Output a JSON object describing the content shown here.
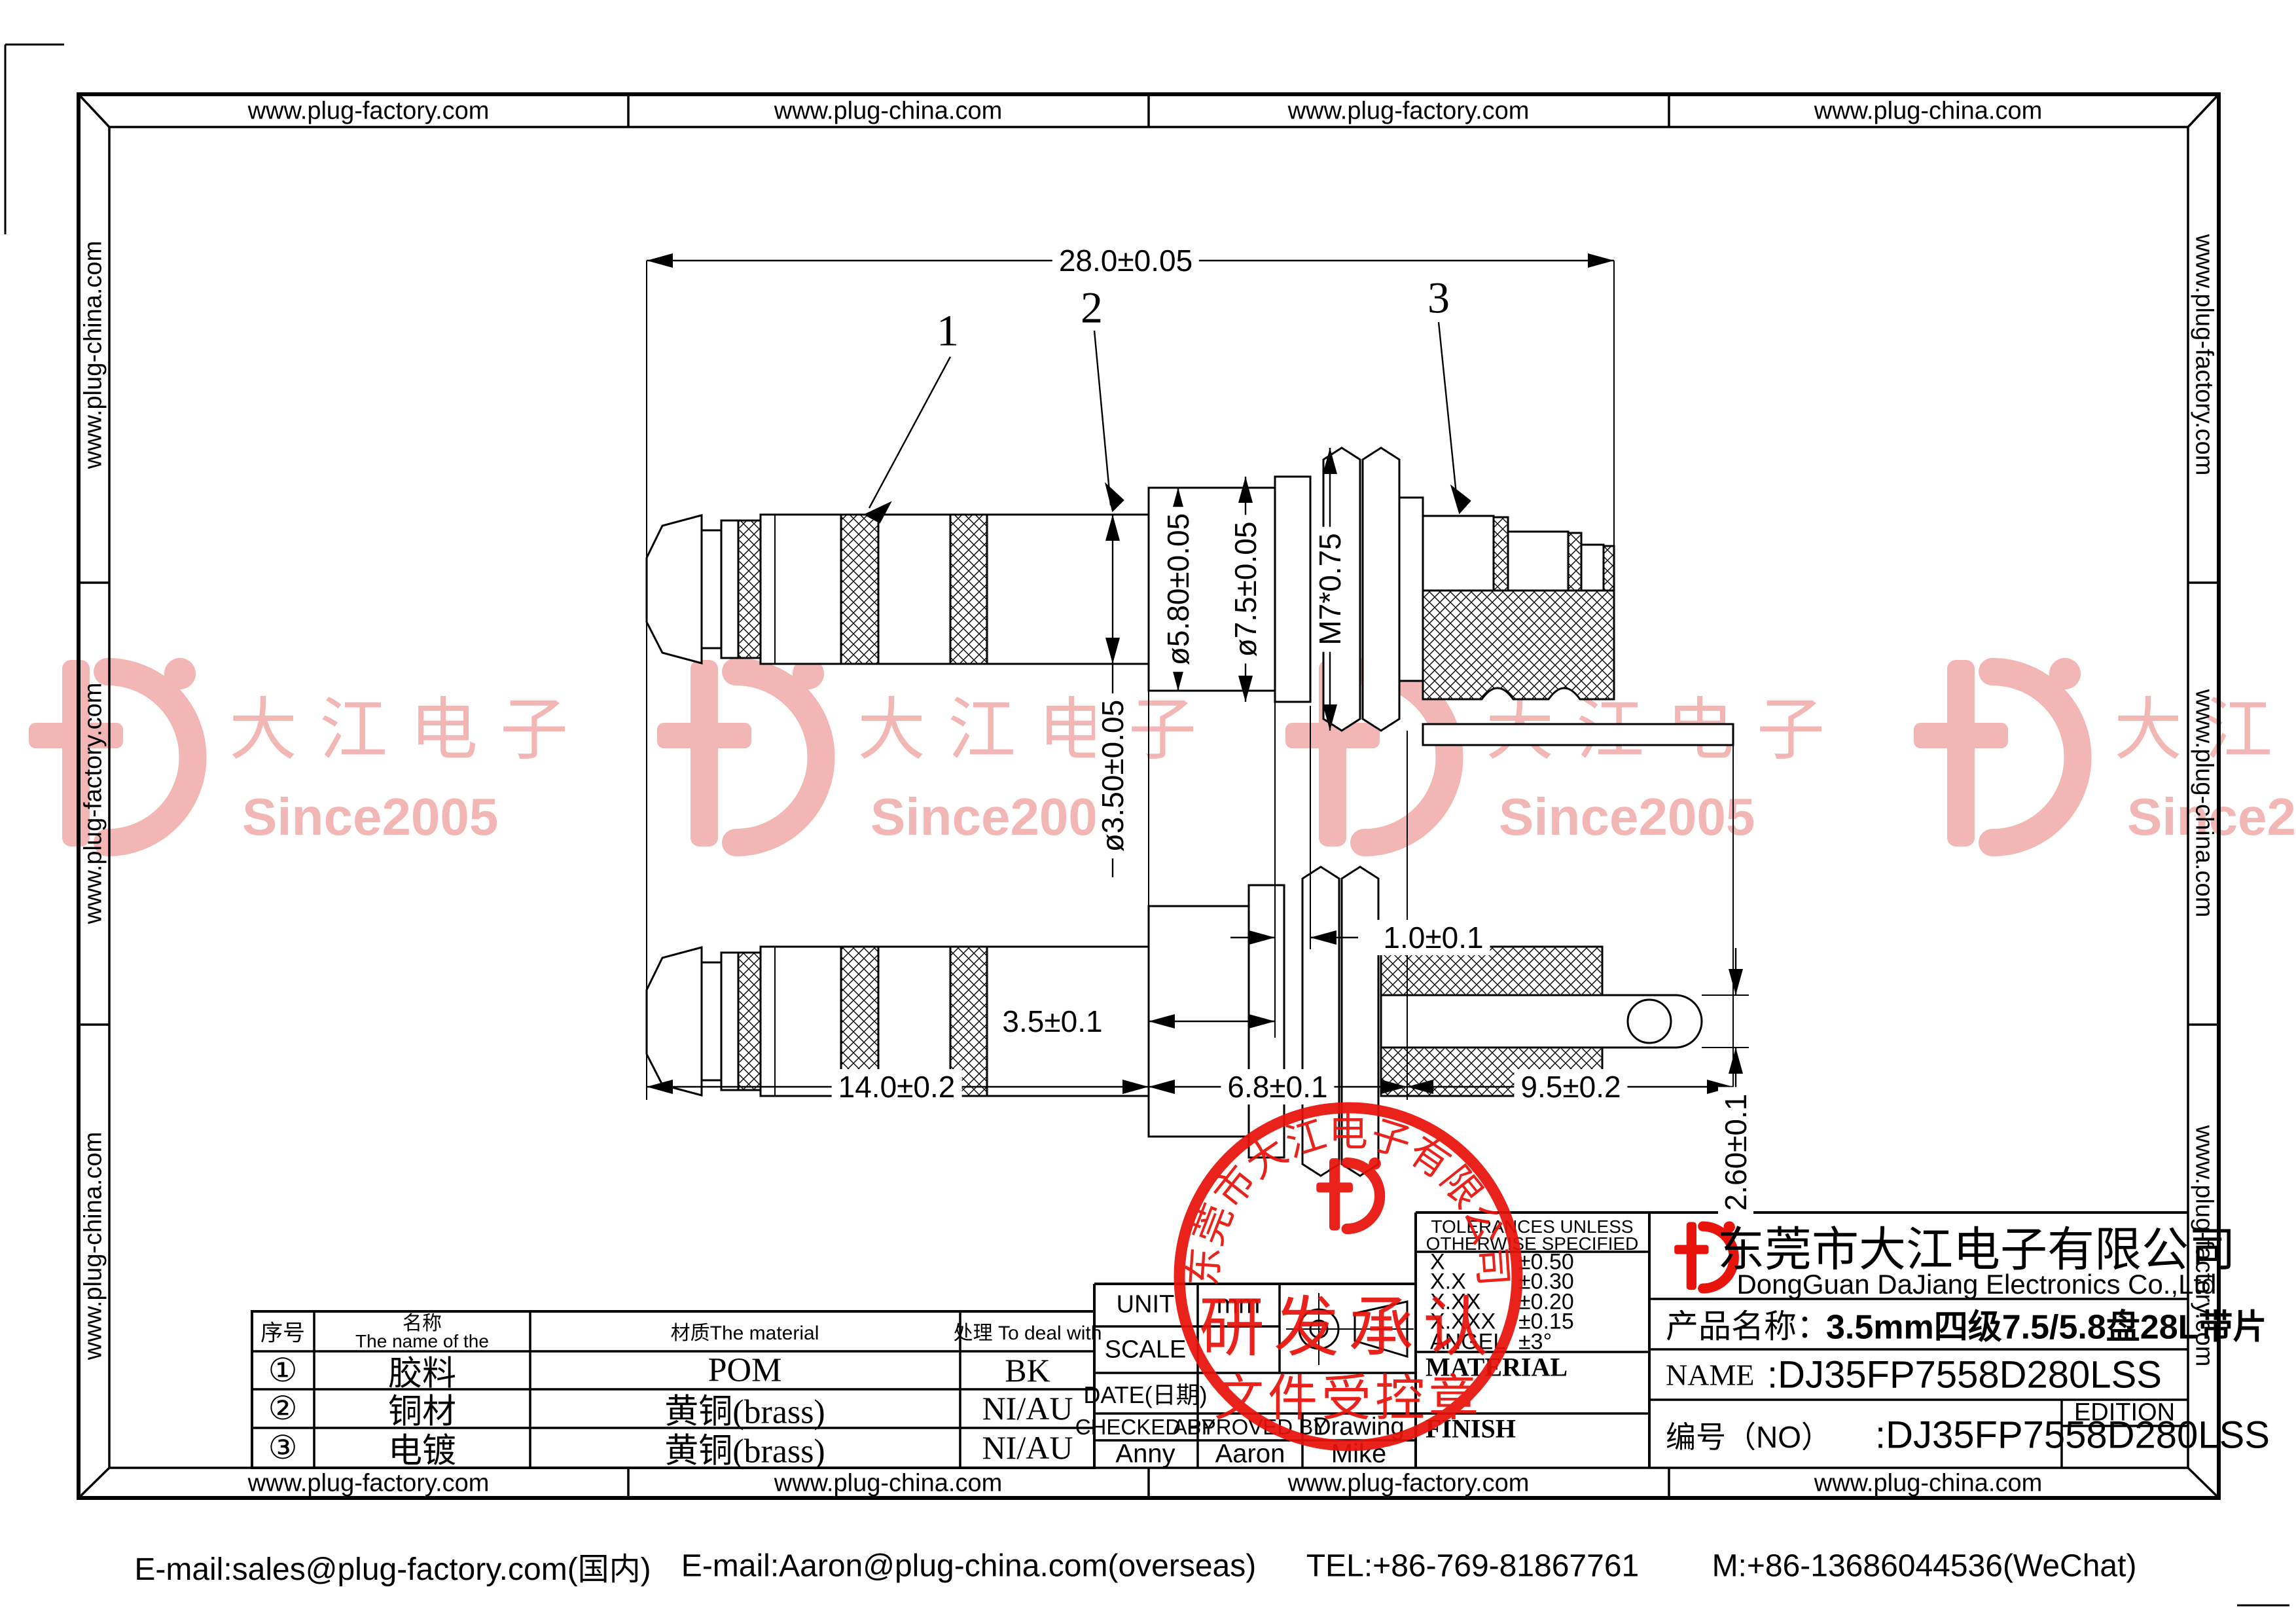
{
  "border": {
    "top": [
      "www.plug-factory.com",
      "www.plug-china.com",
      "www.plug-factory.com",
      "www.plug-china.com"
    ],
    "bottom": [
      "www.plug-factory.com",
      "www.plug-china.com",
      "www.plug-factory.com",
      "www.plug-china.com"
    ],
    "left": [
      "www.plug-china.com",
      "www.plug-factory.com",
      "www.plug-china.com"
    ],
    "right": [
      "www.plug-factory.com",
      "www.plug-china.com",
      "www.plug-factory.com"
    ]
  },
  "watermarks": {
    "brand": "大江电子",
    "since": "Since2005"
  },
  "drawing": {
    "callouts": [
      "1",
      "2",
      "3"
    ],
    "dims": {
      "overall": "28.0±0.05",
      "body": "14.0±0.2",
      "mid": "6.8±0.1",
      "tail": "9.5±0.2",
      "step": "3.5±0.1",
      "washer": "1.0±0.1",
      "tip_dia": "ø3.50±0.05",
      "sleeve_dia": "ø5.80±0.05",
      "flange_dia": "ø7.5±0.05",
      "thread": "M7*0.75",
      "tab": "2.60±0.1"
    }
  },
  "stamp": {
    "arc_text": "东莞市大江电子有限公司",
    "line1": "研发承认",
    "line2": "文件受控章"
  },
  "materials": {
    "col_no": "序号",
    "col_name_cn": "名称",
    "col_name_en": "The name of the",
    "col_material": "材质The material",
    "col_treat": "处理 To deal with",
    "rows": [
      {
        "no": "①",
        "name": "胶料",
        "material": "POM",
        "treat": "BK"
      },
      {
        "no": "②",
        "name": "铜材",
        "material": "黄铜(brass)",
        "treat": "NI/AU"
      },
      {
        "no": "③",
        "name": "电镀",
        "material": "黄铜(brass)",
        "treat": "NI/AU"
      }
    ]
  },
  "titleblock": {
    "unit_label": "UNIT",
    "unit_value": "mm",
    "scale_label": "SCALE",
    "date_label": "DATE(日期)",
    "checked_label": "CHECKED BY",
    "approved_label": "APPROVED BY",
    "drawing_label": "Drawing",
    "checked_value": "Anny",
    "approved_value": "Aaron",
    "drawing_value": "Mike",
    "tol_title1": "TOLERANCES UNLESS",
    "tol_title2": "OTHERWISE SPECIFIED",
    "tolerances": [
      {
        "label": "X",
        "value": "±0.50"
      },
      {
        "label": "X.X",
        "value": "±0.30"
      },
      {
        "label": "X.XX",
        "value": "±0.20"
      },
      {
        "label": "X.XXX",
        "value": "±0.15"
      },
      {
        "label": "ANGEL",
        "value": "±3°"
      }
    ],
    "material_label": "MATERIAL",
    "finish_label": "FINISH",
    "company_cn": "东莞市大江电子有限公司",
    "company_en": "DongGuan DaJiang Electronics Co.,Ltd",
    "product_label": "产品名称：",
    "product_value": "3.5mm四级7.5/5.8盘28L带片",
    "name_label": "NAME",
    "name_value": ":DJ35FP7558D280LSS",
    "no_label": "编号（NO）",
    "no_value": ":DJ35FP7558D280LSS",
    "edition_label": "EDITION"
  },
  "footer": {
    "email1": "E-mail:sales@plug-factory.com(国内)",
    "email2": "E-mail:Aaron@plug-china.com(overseas)",
    "tel": "TEL:+86-769-81867761",
    "mobile": "M:+86-13686044536(WeChat)"
  },
  "colors": {
    "stamp_red": "#e8130b",
    "watermark_pink": "#f2b6b4",
    "line": "#000000"
  }
}
